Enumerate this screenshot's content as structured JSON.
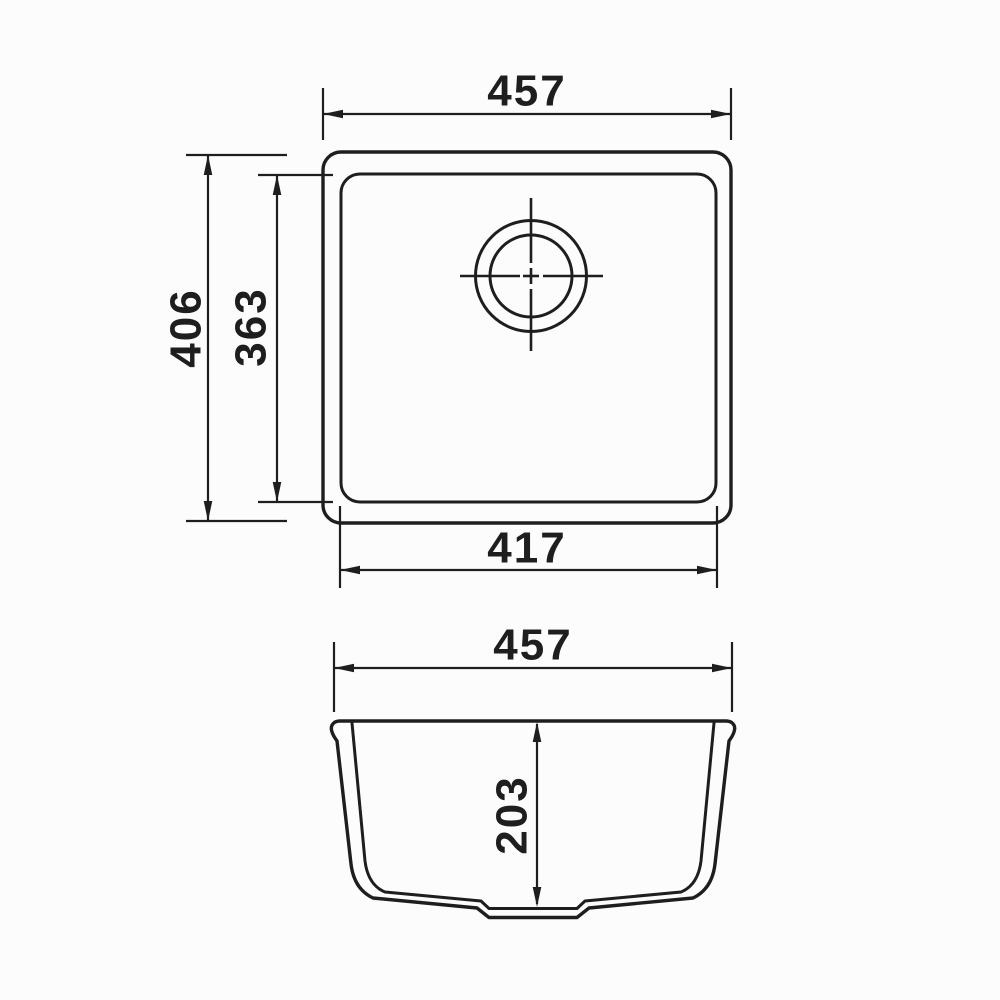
{
  "colors": {
    "line": "#1e1e1e",
    "background": "#fcfcfc"
  },
  "top_view": {
    "width_label": "457",
    "height_label": "406",
    "inner_height_label": "363",
    "inner_width_label": "417"
  },
  "section_view": {
    "width_label": "457",
    "depth_label": "203"
  }
}
